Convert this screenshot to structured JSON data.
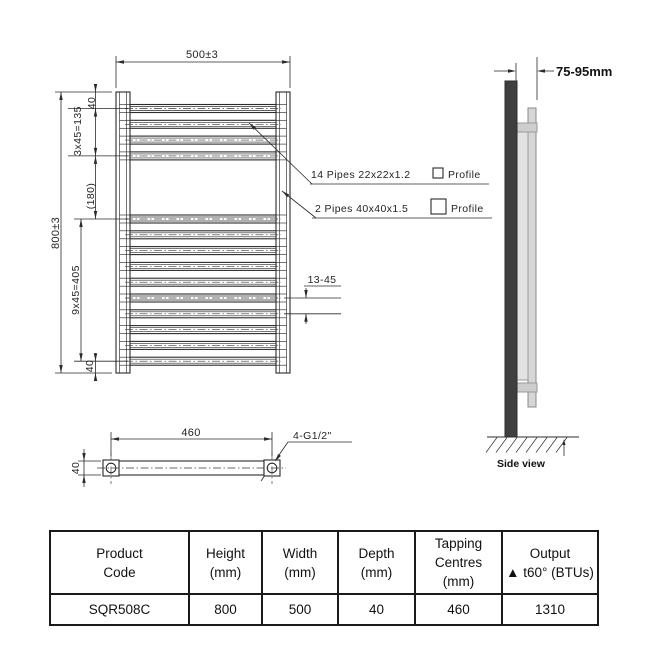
{
  "front_view": {
    "width_dim": "500±3",
    "height_dim": "800±3",
    "top_offset_dim": "40",
    "top_group_dim": "3x45=135",
    "middle_gap_dim": "(180)",
    "bottom_group_dim": "9x45=405",
    "bottom_offset_dim": "40",
    "rail_gap_dim": "13-45",
    "rails": {
      "top_group_count": 4,
      "bottom_group_count": 10
    },
    "pipes_note_1": {
      "text": "14 Pipes 22x22x1.2",
      "profile_label": "Profile"
    },
    "pipes_note_2": {
      "text": "2 Pipes 40x40x1.5",
      "profile_label": "Profile"
    }
  },
  "bottom_view": {
    "centres_dim": "460",
    "depth_dim": "40",
    "tapping_label": "4-G1/2\""
  },
  "side_view": {
    "wall_distance": "75-95mm",
    "caption": "Side view"
  },
  "table": {
    "headers": [
      [
        "Product",
        "Code"
      ],
      [
        "Height",
        "(mm)"
      ],
      [
        "Width",
        "(mm)"
      ],
      [
        "Depth",
        "(mm)"
      ],
      [
        "Tapping",
        "Centres",
        "(mm)"
      ],
      [
        "Output",
        "▲ t60° (BTUs)"
      ]
    ],
    "rows": [
      [
        "SQR508C",
        "800",
        "500",
        "40",
        "460",
        "1310"
      ]
    ]
  },
  "colors": {
    "line": "#2b2b2b",
    "wall_dark": "#3f3f3f",
    "panel_light": "#e2e2e2",
    "bar_mid": "#d6d6d6"
  }
}
